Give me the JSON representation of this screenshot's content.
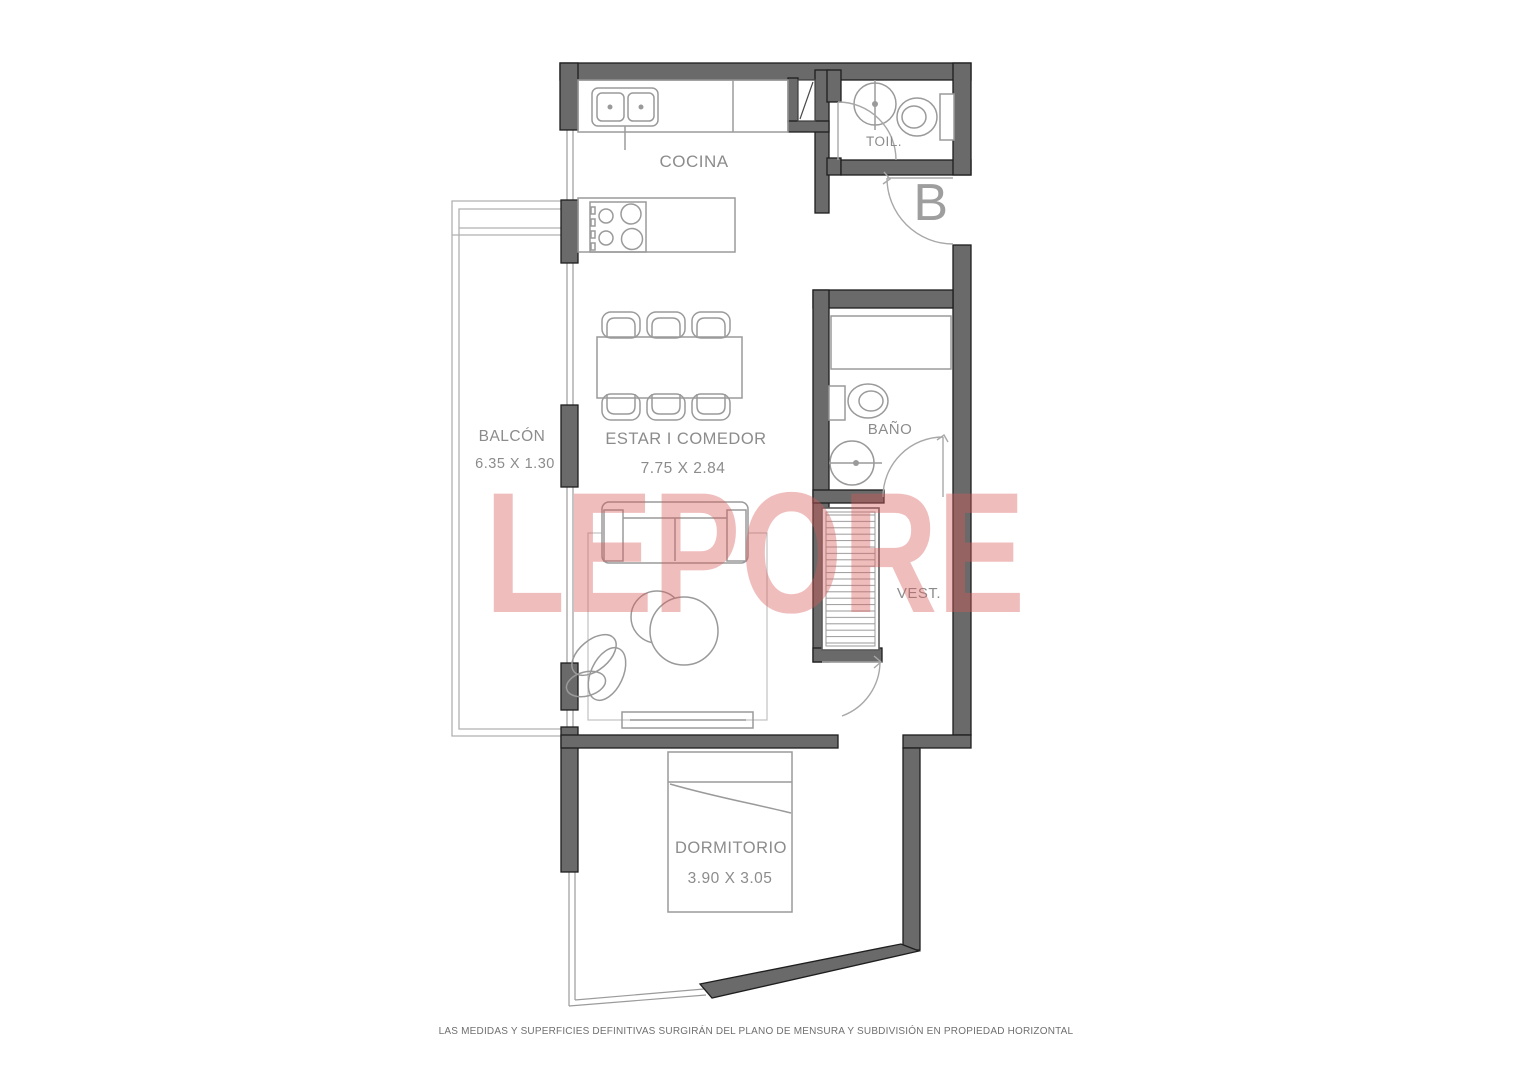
{
  "plan": {
    "unit_letter": "B",
    "watermark": "LEPORE",
    "disclaimer": "LAS MEDIDAS Y SUPERFICIES DEFINITIVAS SURGIRÁN DEL PLANO DE MENSURA Y SUBDIVISIÓN EN PROPIEDAD HORIZONTAL",
    "rooms": {
      "cocina": {
        "label": "COCINA"
      },
      "toilette": {
        "label": "TOIL."
      },
      "bano": {
        "label": "BAÑO"
      },
      "vestidor": {
        "label": "VEST."
      },
      "balcon": {
        "label": "BALCÓN",
        "dimensions": "6.35 X 1.30"
      },
      "estar_comedor": {
        "label": "ESTAR I COMEDOR",
        "dimensions": "7.75 X 2.84"
      },
      "dormitorio": {
        "label": "DORMITORIO",
        "dimensions": "3.90 X 3.05"
      }
    },
    "fixtures": [
      "double-sink",
      "cooktop-4-burners",
      "toilet",
      "wash-basin",
      "shower",
      "dining-table-6-chairs",
      "sofa",
      "coffee-tables",
      "plant",
      "tv-console",
      "wardrobe-closet",
      "bed"
    ]
  },
  "colors": {
    "wall": "#6a6a6a",
    "wall_line": "#1e1e1e",
    "furniture": "#9a9a9a",
    "labels": "#8c8c8c",
    "watermark": "#d95a5a"
  }
}
